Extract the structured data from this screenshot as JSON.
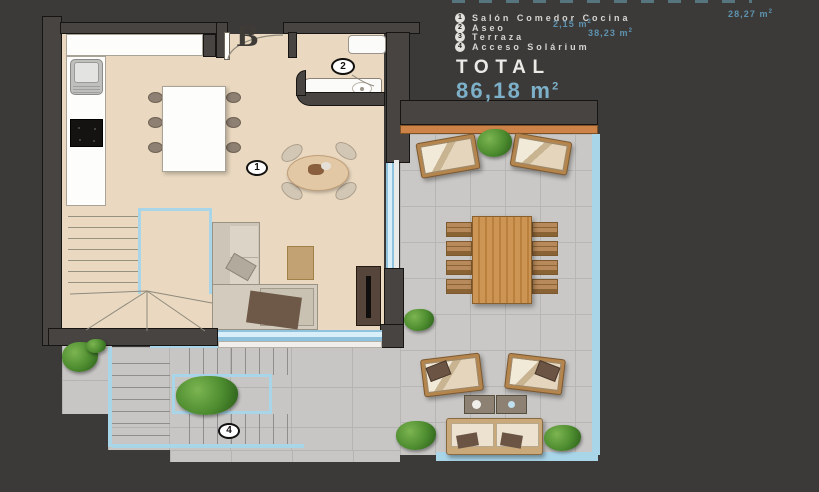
{
  "legend": {
    "items": [
      {
        "num": "1",
        "label": "Salón Comedor Cocina",
        "area": "28,27",
        "unit_base": "m",
        "unit_sup": "2"
      },
      {
        "num": "2",
        "label": "Aseo",
        "area": "2,15",
        "unit_base": "m",
        "unit_sup": "2"
      },
      {
        "num": "3",
        "label": "Terraza",
        "area": "38,23",
        "unit_base": "m",
        "unit_sup": "2"
      },
      {
        "num": "4",
        "label": "Acceso Solárium",
        "area": "",
        "unit_base": "",
        "unit_sup": ""
      }
    ],
    "total_label": "TOTAL",
    "total_value": "86,18",
    "total_unit_base": "m",
    "total_unit_sup": "2"
  },
  "plan": {
    "unit_label": "B",
    "markers": {
      "salon": "1",
      "aseo": "2",
      "solarium": "4"
    }
  },
  "colors": {
    "background": "#3b3a38",
    "interior_floor": "#ead9c0",
    "terrace_floor": "#c9c8c6",
    "glass_blue": "#a9d5e9",
    "beam_orange": "#cd8348",
    "accent_blue": "#5e93b0",
    "total_blue": "#7db0c9"
  }
}
